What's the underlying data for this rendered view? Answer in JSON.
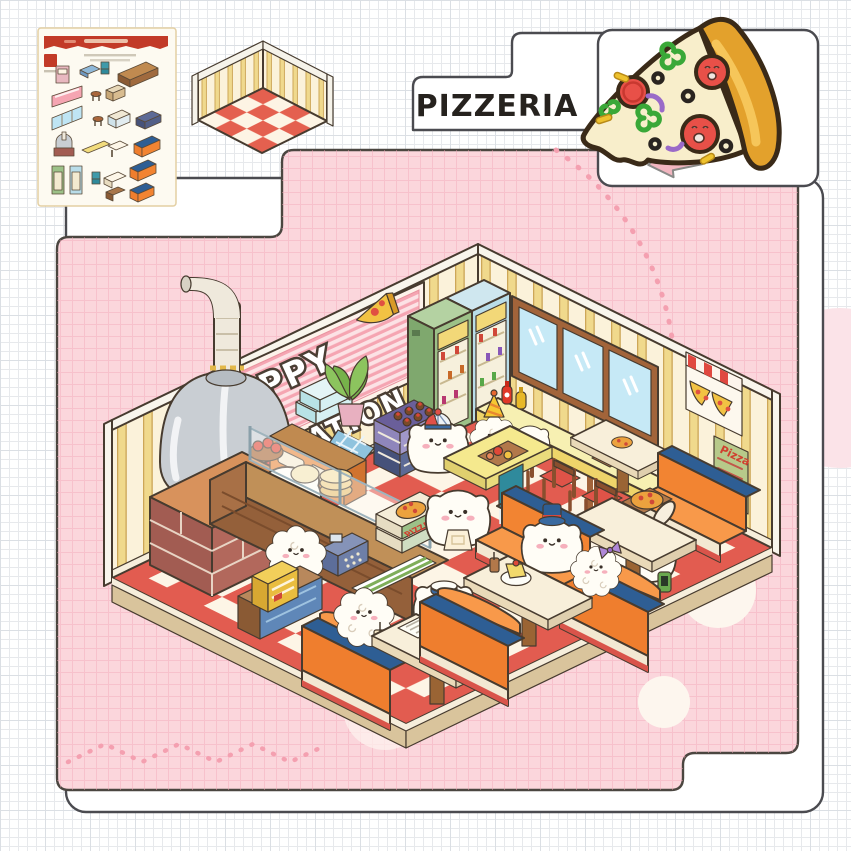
{
  "product_card": {
    "label": "PIZZERIA",
    "card_color": "#ffffff",
    "border_color": "#4b4b50"
  },
  "scene": {
    "sign": {
      "line1": "PUPPY",
      "line2": "VACATION"
    },
    "menu_board": {
      "title": "Pizza"
    },
    "pizza_box": {
      "label": "PIZZA"
    },
    "palette": {
      "panel_pink": "#fbd6dc",
      "panel_grid_pink": "#f2a9b8",
      "checker_red": "#e25c50",
      "checker_cream": "#fdf5e6",
      "wall_cream": "#fbf2da",
      "wall_stripe_yellow": "#f0d98c",
      "booth_orange": "#f08232",
      "booth_rail_blue": "#2e5e94",
      "oven_gray": "#c9ced3",
      "brick_red": "#a25c52",
      "fridge_green": "#9cc188",
      "fridge_blue": "#b9dde9",
      "window_blue": "#c6e9f6",
      "bar_yellow": "#f2dc7d",
      "stool_red": "#df5348",
      "table_cream": "#f7eed8",
      "chair_teal": "#2f9dae",
      "banner_pink": "#f5a5b2"
    }
  },
  "sticker_sheet": {
    "header_color": "#c23a28",
    "items": [
      "poster",
      "banner-sign",
      "window",
      "pizza-oven",
      "drink-fridge-green",
      "drink-fridge-blue",
      "prep-counter",
      "display-counter",
      "long-bench",
      "navy-crate",
      "stool",
      "teal-chair",
      "small-table",
      "white-table",
      "yellow-plank",
      "booth-orange-1",
      "booth-orange-2",
      "booth-orange-3",
      "brown-crate",
      "blue-tray"
    ]
  },
  "room_preview": {
    "wall_color": "#f0d98c",
    "floor_red": "#e4604f",
    "floor_cream": "#fdf4e4"
  }
}
